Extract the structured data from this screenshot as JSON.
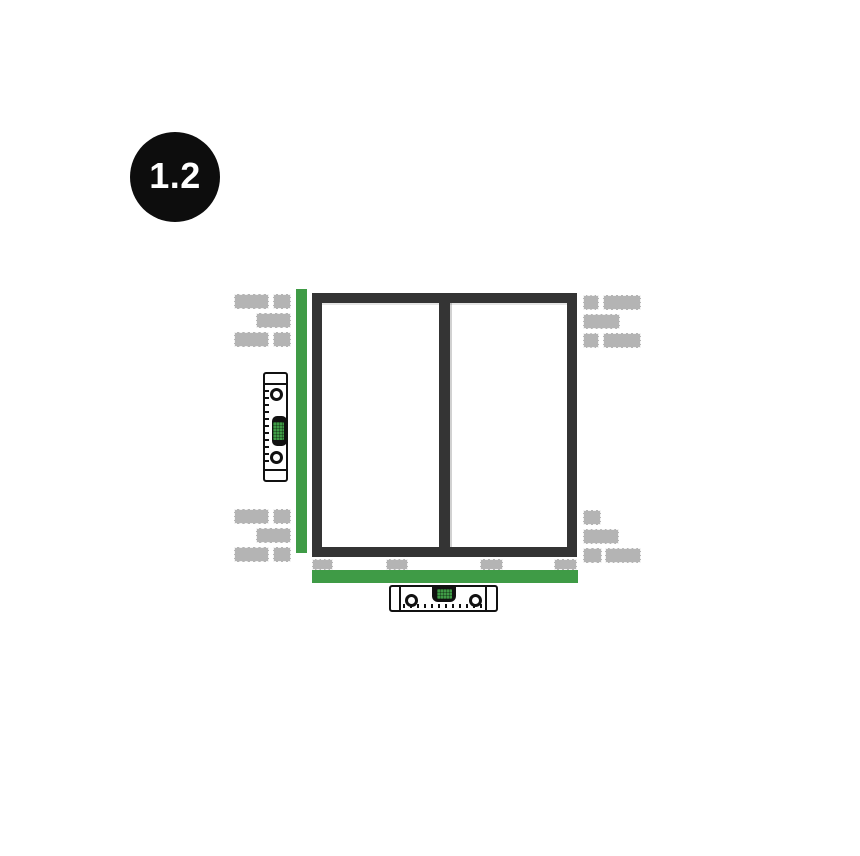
{
  "badge": {
    "label": "1.2"
  },
  "colors": {
    "accent_green": "#3F9B46",
    "frame_dark": "#343434",
    "brick_gray": "#B4B4B4",
    "badge_black": "#0D0D0D",
    "level_outline": "#111111",
    "background": "#FFFFFF"
  },
  "icons": {
    "step_badge": "step-number-badge",
    "window_frame": "window-frame-icon",
    "green_packer_left": "vertical-packer-batten-icon",
    "green_packer_bottom": "horizontal-packer-batten-icon",
    "spirit_level_vertical": "spirit-level-vertical-icon",
    "spirit_level_horizontal": "spirit-level-horizontal-icon",
    "bricks": "brick-wall-icon",
    "spacer_blocks": "support-packer-block-icon"
  }
}
